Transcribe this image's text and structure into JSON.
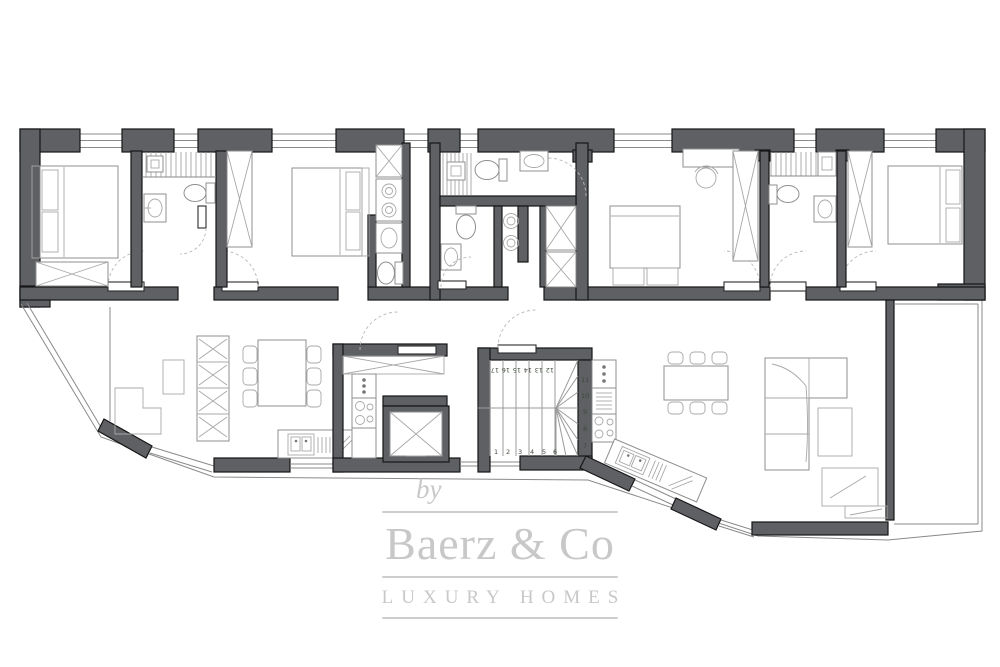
{
  "watermark": {
    "by": "by",
    "brand": "Baerz & Co",
    "tagline": "LUXURY HOMES"
  },
  "stairs": {
    "top_row": [
      "17",
      "16",
      "15",
      "14",
      "13",
      "12"
    ],
    "right_col": [
      "11",
      "10",
      "9",
      "8",
      "7"
    ],
    "bottom_row": [
      "1",
      "2",
      "3",
      "4",
      "5",
      "6"
    ]
  },
  "colors": {
    "wall": "#5e6063",
    "wall_outline": "#161616",
    "furniture_line": "#8f8f8f",
    "glass_line": "#8a8a8a",
    "door_arc": "#b8b8b8",
    "step_numbers": "#3f4a3c",
    "watermark": "#c8c8c8",
    "background": "#ffffff"
  }
}
